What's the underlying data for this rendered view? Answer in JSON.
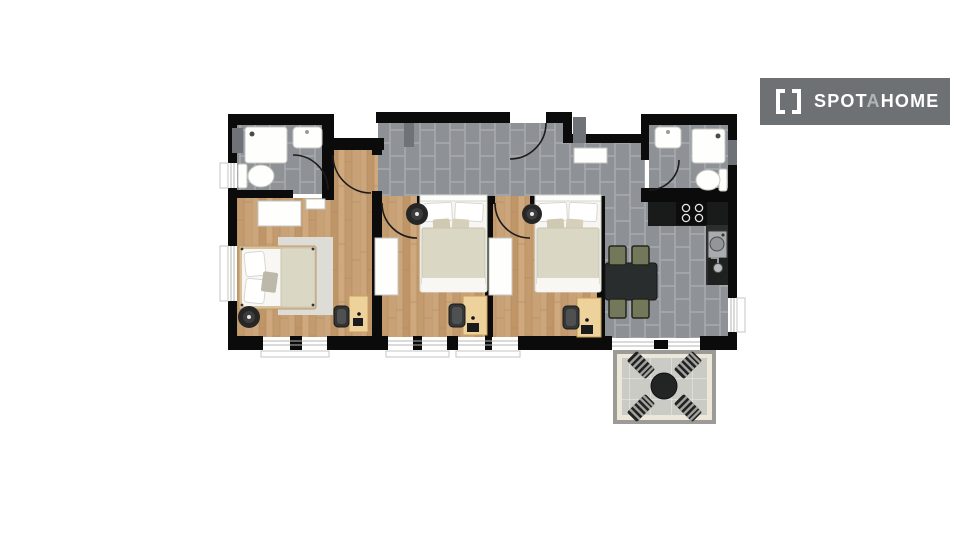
{
  "brand": {
    "icon": "spotahome-brackets-icon",
    "name_part1": "SPOT",
    "name_part2": "A",
    "name_part3": "HOME"
  },
  "colors": {
    "logo_bg": "#6d7174",
    "logo_text": "#ffffff",
    "logo_accent": "#b2b5b6",
    "wall": "#0b0b0b",
    "pillar": "#6f7276",
    "wood": "#c7a074",
    "tile": "#8e9196",
    "grout": "#a6a9ad",
    "balcony_tile": "#cbcbc6",
    "balcony_border": "#ece7d9",
    "rug": "#dedcd6",
    "duvet": "#dad7c5",
    "bedding": "#f8f7f4",
    "desk_wood": "#eed29b",
    "dining_chair": "#74785a",
    "counter": "#191b1b",
    "appliance": "#a9acae"
  },
  "plan": {
    "type": "apartment-floor-plan",
    "rooms": [
      {
        "id": "bathroom-left",
        "floor": "gray-tile",
        "fixtures": [
          "shower",
          "sink",
          "toilet",
          "door"
        ]
      },
      {
        "id": "bedroom-1",
        "floor": "wood",
        "fixtures": [
          "double-bed",
          "rug",
          "wardrobe",
          "pouf",
          "desk",
          "chair",
          "windows"
        ]
      },
      {
        "id": "hallway",
        "floor": "gray-tile",
        "fixtures": [
          "entrance-door",
          "shelf"
        ]
      },
      {
        "id": "bedroom-2",
        "floor": "wood",
        "fixtures": [
          "double-bed",
          "wardrobe",
          "pouf",
          "desk",
          "chair",
          "windows"
        ]
      },
      {
        "id": "bedroom-3",
        "floor": "wood",
        "fixtures": [
          "double-bed",
          "wardrobe",
          "pouf",
          "desk",
          "chair",
          "windows"
        ]
      },
      {
        "id": "kitchen-dining",
        "floor": "gray-tile",
        "fixtures": [
          "counter",
          "stove",
          "washing-machine",
          "sink",
          "dining-table",
          "4-chairs",
          "sliding-door"
        ]
      },
      {
        "id": "bathroom-right",
        "floor": "gray-tile",
        "fixtures": [
          "shower",
          "sink",
          "toilet",
          "door"
        ]
      },
      {
        "id": "balcony",
        "floor": "light-tile",
        "fixtures": [
          "round-table",
          "4-loungers"
        ]
      }
    ]
  }
}
